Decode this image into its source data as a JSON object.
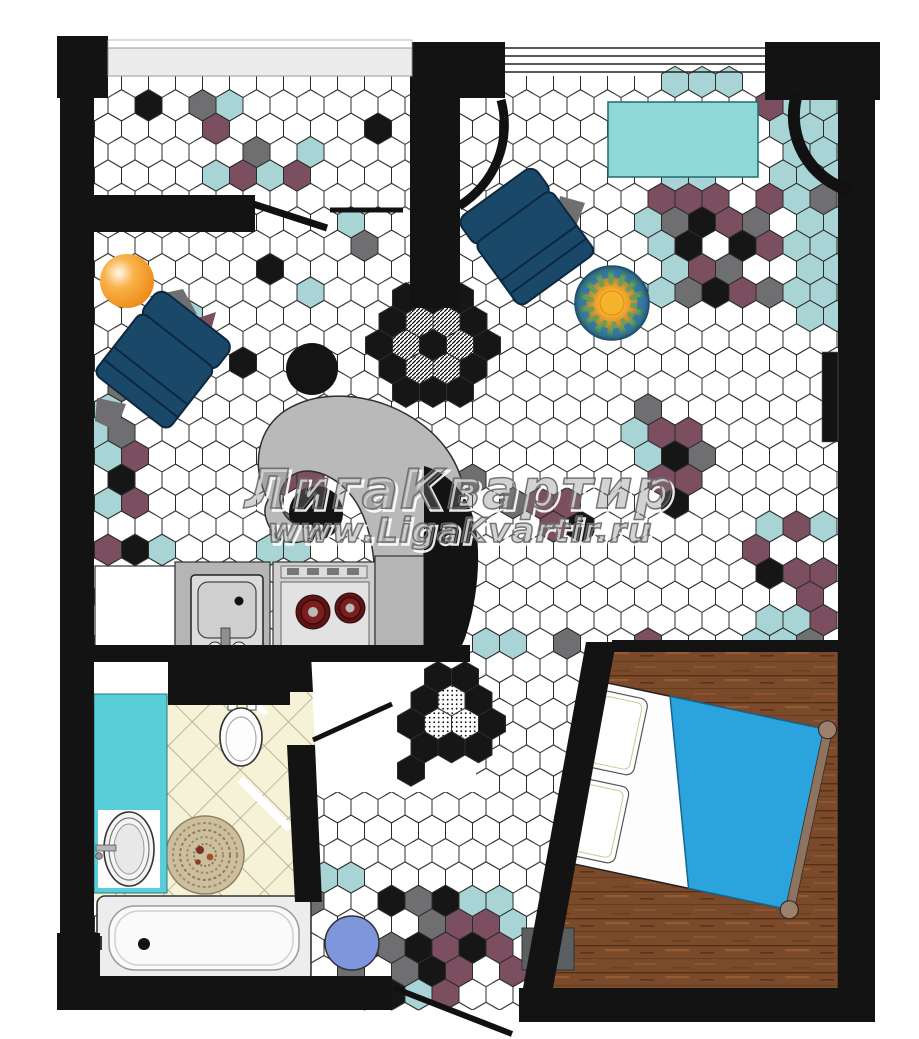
{
  "watermark": {
    "line1": "ЛигаКвартир",
    "line2": "www.LigaKvartir.ru"
  },
  "palette": {
    "wall": "#131313",
    "tile_line": "#2c2c2c",
    "hex_teal": "#a9d4d6",
    "hex_plum": "#7b4e60",
    "hex_gray": "#6f6f71",
    "hex_black": "#161616",
    "big_teal": "#8ed8d8",
    "bath_teal": "#58cfd8",
    "bath_floor": "#f6f2d8",
    "wood": "#7a4a2b",
    "navy": "#1a4868",
    "navy_dark": "#0c2840",
    "blanket": "#2ba3dc",
    "orange": "#ef8c1a",
    "blue_stool": "#7e97dc",
    "counter": "#b5b5b5",
    "stove": "#cfcfcf",
    "burner": "#5c1414",
    "mat": "#5b5f62",
    "blob": "#b9b9b9"
  },
  "accent_tiles": {
    "flower": {
      "cx": 433,
      "cy": 345
    },
    "door_decor": [
      [
        438,
        677,
        "k"
      ],
      [
        465,
        677,
        "k"
      ],
      [
        478.5,
        700.4,
        "k"
      ],
      [
        492,
        723.8,
        "k"
      ],
      [
        478.5,
        747.2,
        "k"
      ],
      [
        451.5,
        747.2,
        "k"
      ],
      [
        424.5,
        747.2,
        "k"
      ],
      [
        411,
        723.8,
        "k"
      ],
      [
        424.5,
        700.4,
        "k"
      ],
      [
        411,
        770.6,
        "k"
      ],
      [
        451.5,
        700.4,
        "d"
      ],
      [
        465,
        723.8,
        "d"
      ],
      [
        438,
        723.8,
        "d"
      ]
    ],
    "cells": [
      [
        149,
        105,
        "k"
      ],
      [
        190,
        105,
        "g"
      ],
      [
        233,
        110,
        "t"
      ],
      [
        212,
        128,
        "p"
      ],
      [
        255,
        150,
        "g"
      ],
      [
        297,
        148,
        "t"
      ],
      [
        212,
        173,
        "t"
      ],
      [
        255,
        173,
        "g"
      ],
      [
        297,
        173,
        "p"
      ],
      [
        233,
        187,
        "p"
      ],
      [
        276,
        187,
        "t"
      ],
      [
        383,
        123,
        "k"
      ],
      [
        342,
        220,
        "t"
      ],
      [
        356,
        248,
        "g"
      ],
      [
        268,
        280,
        "k"
      ],
      [
        315,
        285,
        "g"
      ],
      [
        255,
        367,
        "k"
      ],
      [
        203,
        328,
        "p"
      ],
      [
        189,
        305,
        "t"
      ],
      [
        297,
        300,
        "t"
      ],
      [
        121,
        392,
        "g"
      ],
      [
        107,
        415,
        "t"
      ],
      [
        134,
        438,
        "g"
      ],
      [
        100,
        438,
        "t"
      ],
      [
        107,
        462,
        "t"
      ],
      [
        148,
        460,
        "p"
      ],
      [
        121,
        487,
        "k"
      ],
      [
        110,
        508,
        "t"
      ],
      [
        137,
        510,
        "p"
      ],
      [
        97,
        553,
        "p"
      ],
      [
        125,
        555,
        "k"
      ],
      [
        160,
        553,
        "t"
      ],
      [
        260,
        553,
        "t"
      ],
      [
        300,
        548,
        "t"
      ],
      [
        288,
        487,
        "p"
      ],
      [
        280,
        527,
        "g"
      ],
      [
        310,
        475,
        "p"
      ],
      [
        473,
        473,
        "g"
      ],
      [
        500,
        513,
        "g"
      ],
      [
        540,
        502,
        "p"
      ],
      [
        565,
        513,
        "p"
      ],
      [
        553,
        537,
        "p"
      ],
      [
        580,
        525,
        "k"
      ],
      [
        663,
        88,
        "t"
      ],
      [
        690,
        88,
        "t"
      ],
      [
        717,
        88,
        "t"
      ],
      [
        760,
        105,
        "p"
      ],
      [
        799,
        90,
        "t"
      ],
      [
        826,
        90,
        "t"
      ],
      [
        849,
        90,
        "t"
      ],
      [
        786,
        113,
        "t"
      ],
      [
        813,
        113,
        "t"
      ],
      [
        840,
        113,
        "t"
      ],
      [
        772,
        136,
        "t"
      ],
      [
        799,
        136,
        "t"
      ],
      [
        826,
        136,
        "t"
      ],
      [
        849,
        136,
        "t"
      ],
      [
        786,
        160,
        "t"
      ],
      [
        813,
        160,
        "t"
      ],
      [
        840,
        160,
        "t"
      ],
      [
        772,
        183,
        "t"
      ],
      [
        799,
        183,
        "t"
      ],
      [
        826,
        183,
        "t"
      ],
      [
        849,
        183,
        "t"
      ],
      [
        786,
        206,
        "t"
      ],
      [
        813,
        206,
        "t"
      ],
      [
        840,
        206,
        "t"
      ],
      [
        799,
        230,
        "t"
      ],
      [
        826,
        230,
        "t"
      ],
      [
        849,
        230,
        "t"
      ],
      [
        786,
        253,
        "t"
      ],
      [
        813,
        253,
        "t"
      ],
      [
        840,
        253,
        "t"
      ],
      [
        799,
        276,
        "t"
      ],
      [
        826,
        276,
        "t"
      ],
      [
        849,
        276,
        "t"
      ],
      [
        786,
        300,
        "t"
      ],
      [
        813,
        300,
        "t"
      ],
      [
        840,
        300,
        "t"
      ],
      [
        799,
        323,
        "t"
      ],
      [
        826,
        323,
        "t"
      ],
      [
        849,
        323,
        "t"
      ],
      [
        773,
        200,
        "p"
      ],
      [
        823,
        205,
        "g"
      ],
      [
        677,
        180,
        "t"
      ],
      [
        704,
        180,
        "t"
      ],
      [
        650,
        203,
        "t"
      ],
      [
        637,
        226,
        "t"
      ],
      [
        650,
        249,
        "t"
      ],
      [
        664,
        273,
        "t"
      ],
      [
        637,
        296,
        "t"
      ],
      [
        650,
        296,
        "t"
      ],
      [
        664,
        203,
        "p"
      ],
      [
        691,
        203,
        "p"
      ],
      [
        718,
        206,
        "p"
      ],
      [
        677,
        226,
        "p"
      ],
      [
        731,
        226,
        "p"
      ],
      [
        745,
        253,
        "p"
      ],
      [
        691,
        276,
        "p"
      ],
      [
        718,
        276,
        "p"
      ],
      [
        745,
        300,
        "p"
      ],
      [
        772,
        253,
        "p"
      ],
      [
        704,
        226,
        "k"
      ],
      [
        677,
        249,
        "k"
      ],
      [
        731,
        249,
        "k"
      ],
      [
        704,
        296,
        "k"
      ],
      [
        758,
        226,
        "g"
      ],
      [
        731,
        276,
        "g"
      ],
      [
        758,
        300,
        "g"
      ],
      [
        691,
        300,
        "g"
      ],
      [
        664,
        226,
        "g"
      ],
      [
        650,
        420,
        "g"
      ],
      [
        637,
        443,
        "t"
      ],
      [
        664,
        443,
        "p"
      ],
      [
        691,
        443,
        "p"
      ],
      [
        704,
        466,
        "g"
      ],
      [
        677,
        466,
        "k"
      ],
      [
        664,
        490,
        "p"
      ],
      [
        691,
        490,
        "p"
      ],
      [
        677,
        513,
        "k"
      ],
      [
        650,
        466,
        "t"
      ],
      [
        778,
        528,
        "t"
      ],
      [
        830,
        528,
        "t"
      ],
      [
        808,
        538,
        "p"
      ],
      [
        768,
        547,
        "p"
      ],
      [
        782,
        565,
        "k"
      ],
      [
        812,
        563,
        "k"
      ],
      [
        800,
        578,
        "p"
      ],
      [
        822,
        582,
        "p"
      ],
      [
        803,
        600,
        "p"
      ],
      [
        770,
        615,
        "t"
      ],
      [
        808,
        615,
        "k"
      ],
      [
        820,
        628,
        "p"
      ],
      [
        768,
        640,
        "t"
      ],
      [
        795,
        628,
        "t"
      ],
      [
        822,
        650,
        "t"
      ],
      [
        795,
        650,
        "p"
      ],
      [
        497,
        637,
        "t"
      ],
      [
        524,
        650,
        "t"
      ],
      [
        570,
        637,
        "g"
      ],
      [
        597,
        660,
        "k"
      ],
      [
        645,
        637,
        "p"
      ],
      [
        658,
        660,
        "p"
      ],
      [
        745,
        637,
        "t"
      ],
      [
        772,
        650,
        "t"
      ],
      [
        799,
        637,
        "g"
      ],
      [
        329,
        887,
        "t"
      ],
      [
        356,
        887,
        "t"
      ],
      [
        383,
        900,
        "k"
      ],
      [
        410,
        893,
        "g"
      ],
      [
        437,
        893,
        "p"
      ],
      [
        464,
        910,
        "t"
      ],
      [
        491,
        887,
        "w"
      ],
      [
        505,
        893,
        "t"
      ],
      [
        315,
        910,
        "g"
      ],
      [
        396,
        920,
        "w"
      ],
      [
        423,
        916,
        "g"
      ],
      [
        450,
        910,
        "k"
      ],
      [
        477,
        916,
        "p"
      ],
      [
        504,
        916,
        "t"
      ],
      [
        383,
        940,
        "g"
      ],
      [
        410,
        940,
        "k"
      ],
      [
        437,
        940,
        "g"
      ],
      [
        464,
        933,
        "p"
      ],
      [
        491,
        933,
        "p"
      ],
      [
        511,
        945,
        "p"
      ],
      [
        342,
        963,
        "g"
      ],
      [
        369,
        957,
        "k"
      ],
      [
        396,
        963,
        "g"
      ],
      [
        423,
        963,
        "k"
      ],
      [
        450,
        957,
        "p"
      ],
      [
        477,
        957,
        "k"
      ],
      [
        504,
        963,
        "p"
      ],
      [
        356,
        985,
        "t"
      ],
      [
        383,
        985,
        "k"
      ],
      [
        410,
        987,
        "t"
      ],
      [
        437,
        985,
        "p"
      ],
      [
        464,
        980,
        "p"
      ]
    ]
  }
}
